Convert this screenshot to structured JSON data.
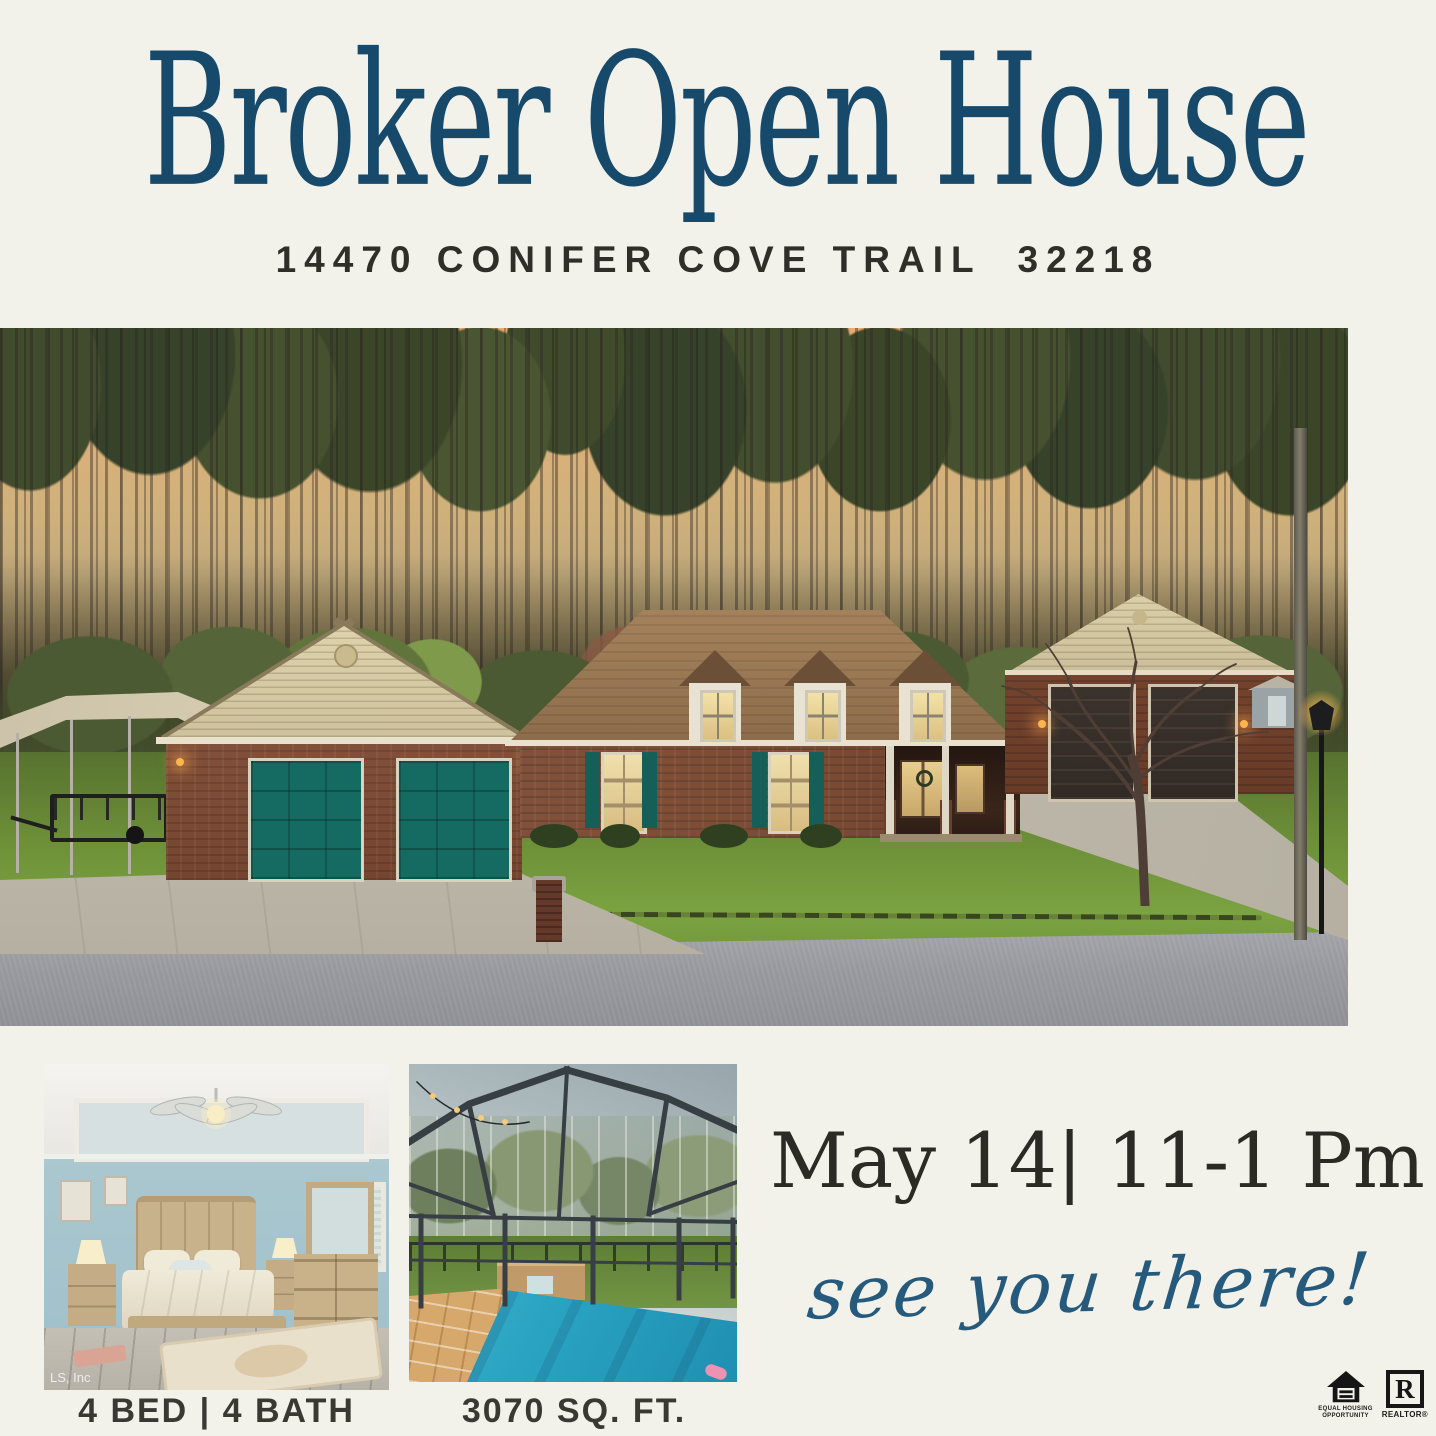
{
  "header": {
    "title": "Broker Open House",
    "address": "14470 CONIFER COVE TRAIL  32218"
  },
  "event": {
    "datetime": "May 14| 11-1 Pm",
    "tagline": "see you there!"
  },
  "captions": {
    "beds_baths": "4 BED | 4 BATH",
    "sqft": "3070 SQ. FT."
  },
  "photos": {
    "main_label": "house-exterior-dusk-photo",
    "bedroom_label": "bedroom-photo",
    "pool_label": "screened-pool-photo",
    "watermark": "LS, Inc"
  },
  "footer": {
    "equal_housing_line1": "EQUAL HOUSING",
    "equal_housing_line2": "OPPORTUNITY",
    "realtor_initial": "R",
    "realtor_label": "REALTOR®"
  },
  "colors": {
    "background": "#f2f1ea",
    "accent_navy": "#17496b",
    "script_blue": "#265a7d",
    "text_dark": "#33312c",
    "teal_garage": "#156a61",
    "brick": "#7c4a33",
    "roof_brown": "#9c7a56",
    "sunset_sky": "#f2bd82",
    "pool_blue": "#2aa3c2"
  }
}
